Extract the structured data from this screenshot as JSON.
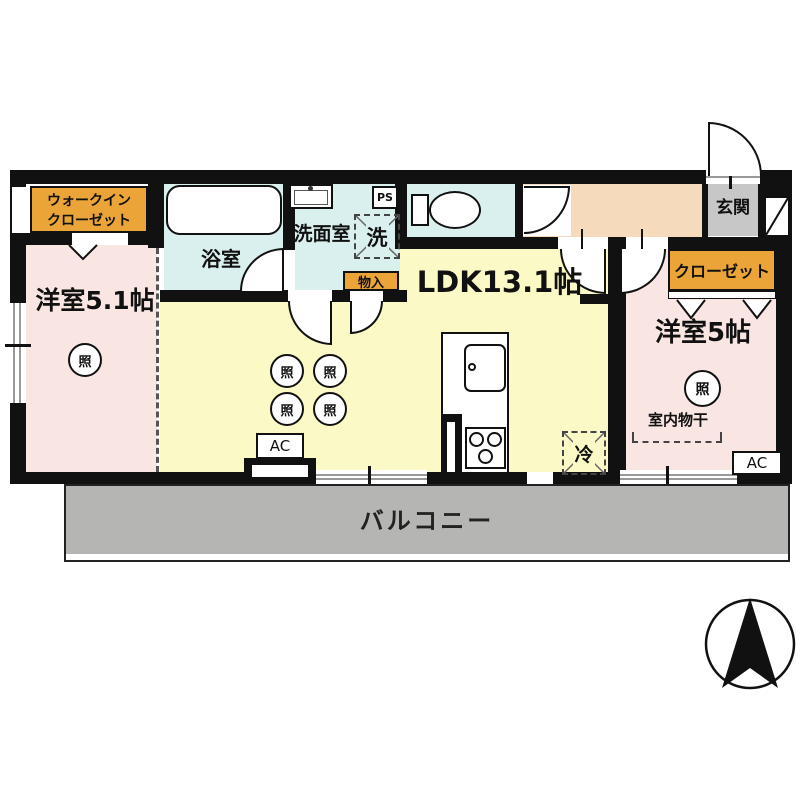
{
  "rooms": {
    "walk_in_closet": {
      "line1": "ウォークイン",
      "line2": "クローゼット"
    },
    "bedroom_left": {
      "label": "洋室5.1帖"
    },
    "bathroom": {
      "label": "浴室"
    },
    "washroom": {
      "label": "洗面室"
    },
    "ldk": {
      "label": "LDK13.1帖"
    },
    "entrance": {
      "label": "玄関"
    },
    "closet": {
      "label": "クローゼット"
    },
    "bedroom_right": {
      "label": "洋室5帖"
    },
    "balcony": {
      "label": "バルコニー"
    }
  },
  "fixtures": {
    "pipe_space": "PS",
    "washing_machine": "洗",
    "storage": "物入",
    "refrigerator": "冷",
    "ac_ldk": "AC",
    "ac_bedroom": "AC",
    "indoor_drying": "室内物干",
    "light": "照"
  },
  "colors": {
    "wall": "#111111",
    "bedroom_floor": "#f9e6e3",
    "ldk_floor": "#fbf9c6",
    "wet_floor": "#d9f0ef",
    "hallway_floor": "#f5dabb",
    "entrance_floor": "#c7c7c7",
    "balcony_floor": "#b5b5b4",
    "label_orange": "#eaa437"
  }
}
